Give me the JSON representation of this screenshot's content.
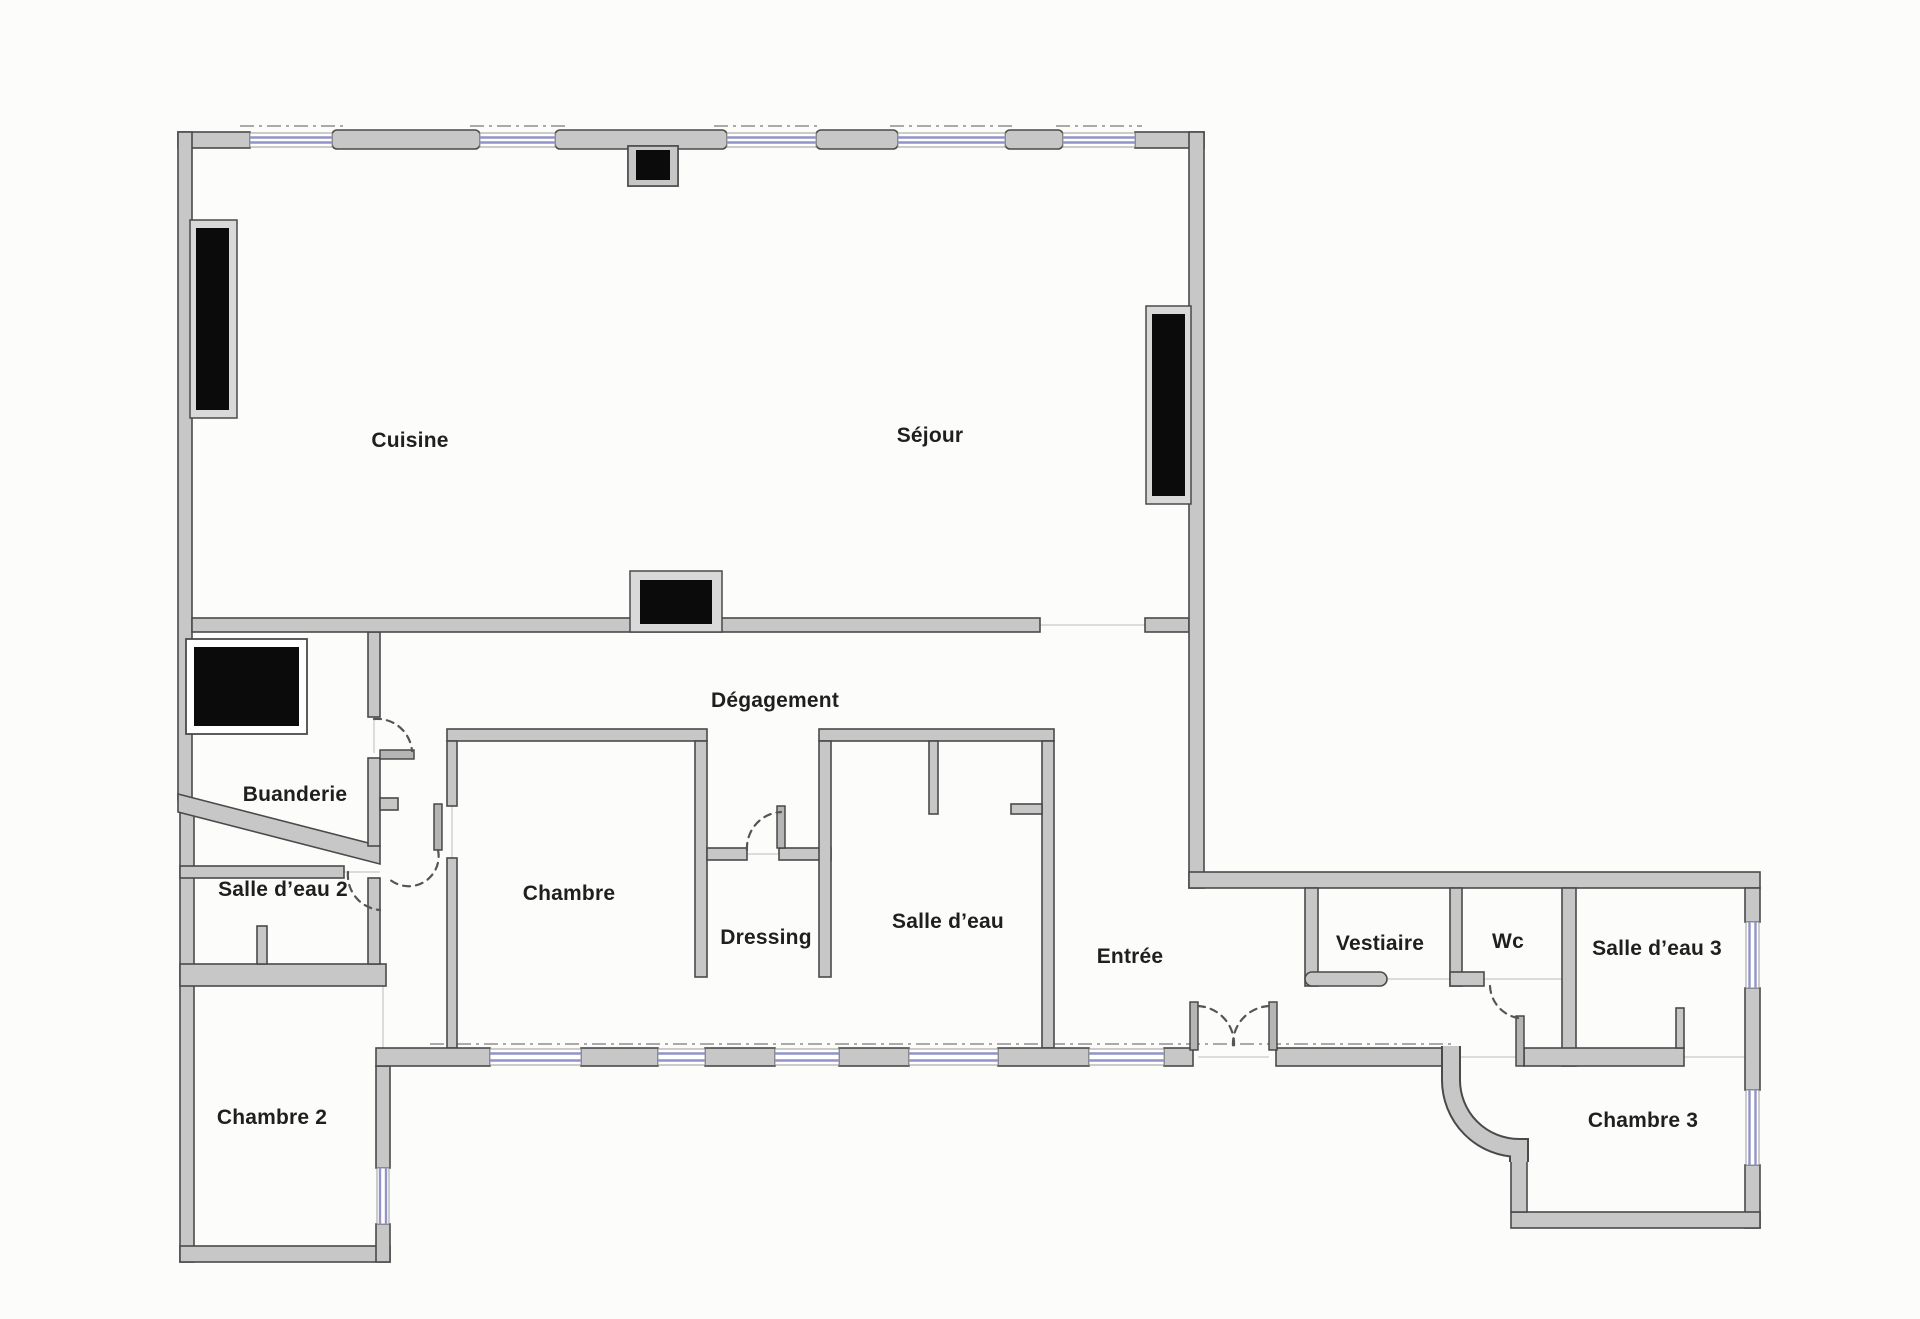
{
  "floorplan": {
    "title": "Plan d'appartement",
    "rooms": [
      {
        "id": "cuisine",
        "label": "Cuisine"
      },
      {
        "id": "sejour",
        "label": "Séjour"
      },
      {
        "id": "degagement",
        "label": "Dégagement"
      },
      {
        "id": "buanderie",
        "label": "Buanderie"
      },
      {
        "id": "salle-deau-2",
        "label": "Salle d’eau 2"
      },
      {
        "id": "chambre",
        "label": "Chambre"
      },
      {
        "id": "dressing",
        "label": "Dressing"
      },
      {
        "id": "salle-deau",
        "label": "Salle d’eau"
      },
      {
        "id": "entree",
        "label": "Entrée"
      },
      {
        "id": "vestiaire",
        "label": "Vestiaire"
      },
      {
        "id": "wc",
        "label": "Wc"
      },
      {
        "id": "salle-deau-3",
        "label": "Salle d’eau 3"
      },
      {
        "id": "chambre-2",
        "label": "Chambre 2"
      },
      {
        "id": "chambre-3",
        "label": "Chambre 3"
      }
    ],
    "legend": {
      "window_symbol": "double blue line",
      "door_symbol": "dashed quarter-circle swing",
      "radiator_symbol": "black filled block"
    },
    "palette": {
      "background": "#fcfcfb",
      "wall_fill": "#c7c7c7",
      "wall_edge": "#4a4a4a",
      "window_glass": "#9193c9",
      "radiator_black": "#0b0b0b",
      "label_ink": "#1f1f1f"
    }
  }
}
